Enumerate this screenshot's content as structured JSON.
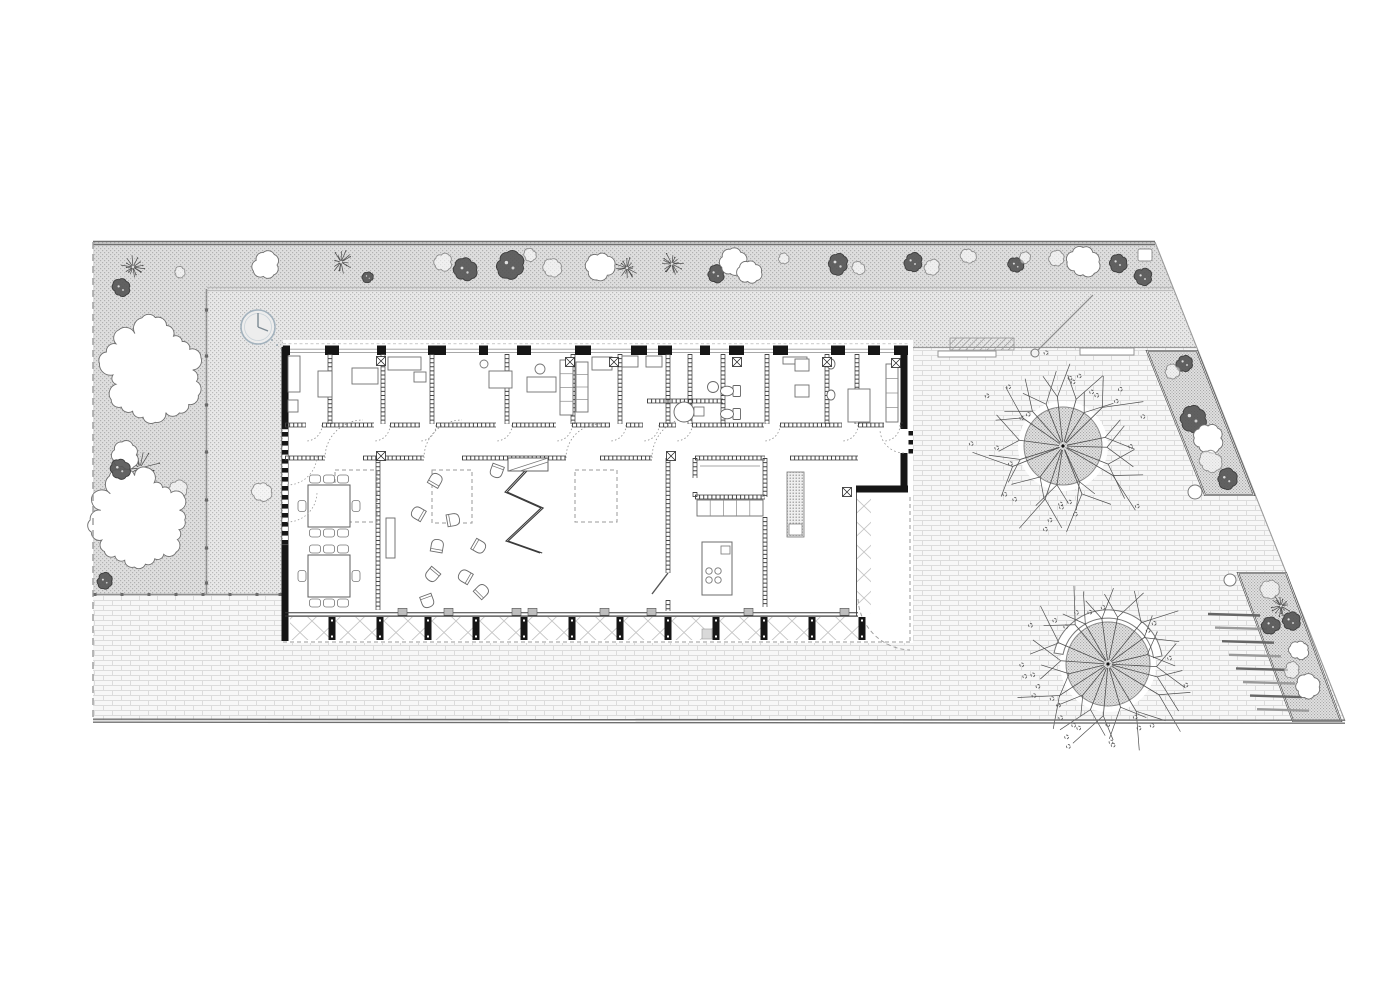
{
  "meta": {
    "width": 1400,
    "height": 990,
    "title": "site-floor-plan"
  },
  "colors": {
    "ink": "#1f1f1f",
    "wall": "#161616",
    "mid": "#555555",
    "soft": "#8a8a8a",
    "light": "#9c9c9c",
    "faint": "#bdbdbd",
    "white": "#ffffff",
    "hatch_bg": "#e8e8e8",
    "hatch_dot": "#b9b9b9",
    "bed_bg": "#e1e1e1",
    "bed_dot": "#a8a8a8",
    "brick_bg": "#f7f7f7",
    "brick_line": "#dcdcdc",
    "deck": "#c6c6c6",
    "clock": "#a3b2bd",
    "boundary": "#6f6f6f"
  },
  "site": {
    "outline": [
      [
        93,
        242
      ],
      [
        1155,
        242
      ],
      [
        1345,
        721
      ],
      [
        93,
        721
      ]
    ],
    "top_line_y": [
      241.5,
      244.5
    ],
    "left_dash_x": 93,
    "bottom_line_y": [
      719.2,
      722.2
    ],
    "slope": [
      1155,
      242,
      1345,
      721
    ]
  },
  "regions": {
    "grass_L": [
      [
        93,
        242
      ],
      [
        1155,
        242
      ],
      [
        1174,
        289
      ],
      [
        207,
        289
      ],
      [
        207,
        595
      ],
      [
        93,
        595
      ]
    ],
    "court": [
      [
        207,
        289
      ],
      [
        1174,
        289
      ],
      [
        1197,
        348
      ],
      [
        285,
        348
      ],
      [
        285,
        595
      ],
      [
        207,
        595
      ]
    ]
  },
  "courtyard": {
    "band_y289": {
      "x1": 207,
      "x2": 1173,
      "ys": [
        287.5,
        290.5
      ]
    },
    "vline207": {
      "x": 206.5,
      "y1": 289,
      "y2": 595,
      "dots_y": [
        310,
        356,
        405,
        452,
        500,
        548,
        583
      ]
    },
    "hline595": {
      "y": 594.5,
      "x1": 93,
      "x2": 284,
      "dots_x": [
        95,
        122,
        149,
        176,
        203,
        230,
        257,
        280
      ]
    },
    "hline348": {
      "y": 347.5,
      "x1": 908,
      "x2": 1196
    },
    "clock": {
      "c": [
        258,
        327
      ],
      "r": 17,
      "hands": [
        [
          258,
          313
        ],
        [
          268,
          331
        ]
      ],
      "trail": [
        [
          272,
          340
        ],
        [
          277,
          345
        ],
        [
          282,
          350
        ]
      ]
    },
    "pole": {
      "line": [
        1035,
        353,
        1093,
        295
      ],
      "circle": [
        1035,
        353,
        4
      ]
    },
    "ramp": [
      950,
      338,
      64,
      12
    ],
    "benches": [
      [
        938,
        351,
        58,
        6
      ],
      [
        1080,
        348,
        54,
        7
      ]
    ],
    "bench_sq": [
      1138,
      249,
      14,
      12
    ]
  },
  "beds": [
    {
      "poly": [
        [
          1147,
          351
        ],
        [
          1197,
          351
        ],
        [
          1254,
          495
        ],
        [
          1205,
          495
        ]
      ]
    },
    {
      "poly": [
        [
          1238,
          573
        ],
        [
          1286,
          573
        ],
        [
          1341,
          721
        ],
        [
          1293,
          721
        ]
      ]
    }
  ],
  "pots": [
    [
      1195,
      492,
      7
    ],
    [
      1230,
      580,
      6
    ]
  ],
  "steps": {
    "x0": 1208,
    "y0": 614,
    "dx": 7,
    "dy": 13.6,
    "len": 52,
    "n": 8
  },
  "trees_large": [
    {
      "c": [
        1063,
        446
      ],
      "canopy": 39,
      "branch": 88,
      "n": 19,
      "seed": 7,
      "leaves": 26
    },
    {
      "c": [
        1108,
        664
      ],
      "canopy": 42,
      "branch": 92,
      "n": 19,
      "seed": 13,
      "leaves": 28,
      "bench": {
        "r1": 46,
        "r2": 55,
        "path": "M1054,653 A55,55 0 0 1 1162,656 L1153.5,657.6 A46,46 0 0 0 1063,654.4 Z"
      }
    }
  ],
  "flora": [
    [
      "spiky",
      133,
      267,
      12
    ],
    [
      "blob",
      121,
      288,
      8
    ],
    [
      "scrib",
      180,
      272,
      5
    ],
    [
      "cloud",
      266,
      265,
      13
    ],
    [
      "spiky",
      341,
      262,
      12
    ],
    [
      "blob",
      368,
      277,
      5
    ],
    [
      "scrib",
      443,
      262,
      8
    ],
    [
      "blob",
      465,
      270,
      10
    ],
    [
      "blob",
      510,
      265,
      12
    ],
    [
      "scrib",
      530,
      255,
      6
    ],
    [
      "scrib",
      553,
      268,
      9
    ],
    [
      "cloud",
      600,
      266,
      13
    ],
    [
      "spiky",
      627,
      268,
      11
    ],
    [
      "spiky",
      672,
      264,
      12
    ],
    [
      "blob",
      716,
      274,
      8
    ],
    [
      "cloud",
      733,
      262,
      12
    ],
    [
      "cloud",
      750,
      272,
      11
    ],
    [
      "scrib",
      784,
      259,
      5
    ],
    [
      "blob",
      838,
      264,
      10
    ],
    [
      "scrib",
      858,
      268,
      6
    ],
    [
      "blob",
      913,
      262,
      8
    ],
    [
      "scrib",
      932,
      267,
      7
    ],
    [
      "scrib",
      968,
      256,
      7
    ],
    [
      "blob",
      1016,
      265,
      7
    ],
    [
      "scrib",
      1025,
      258,
      5
    ],
    [
      "scrib",
      1057,
      259,
      7
    ],
    [
      "cloud",
      1083,
      262,
      14
    ],
    [
      "blob",
      1118,
      263,
      8
    ],
    [
      "blob",
      1143,
      277,
      8
    ],
    [
      "cloud",
      152,
      370,
      46
    ],
    [
      "spiky",
      140,
      468,
      20
    ],
    [
      "scrib",
      177,
      490,
      9
    ],
    [
      "cloud",
      140,
      520,
      47
    ],
    [
      "cloud",
      125,
      455,
      13
    ],
    [
      "blob",
      120,
      469,
      9
    ],
    [
      "scrib",
      262,
      492,
      9
    ],
    [
      "blob",
      105,
      581,
      7
    ],
    [
      "blob",
      1185,
      363,
      8
    ],
    [
      "scrib",
      1172,
      372,
      7
    ],
    [
      "blob",
      1193,
      418,
      12
    ],
    [
      "cloud",
      1208,
      438,
      14
    ],
    [
      "scrib",
      1210,
      462,
      10
    ],
    [
      "blob",
      1227,
      479,
      9
    ],
    [
      "scrib",
      1270,
      589,
      9
    ],
    [
      "spiky",
      1281,
      606,
      11
    ],
    [
      "blob",
      1271,
      625,
      8
    ],
    [
      "blob",
      1291,
      621,
      8
    ],
    [
      "cloud",
      1299,
      650,
      9
    ],
    [
      "scrib",
      1292,
      670,
      7
    ],
    [
      "cloud",
      1307,
      687,
      11
    ]
  ],
  "building": {
    "white": [
      283,
      340,
      630,
      303
    ],
    "top_wall": {
      "y": 345.5,
      "h": 9.5,
      "x1": 283,
      "x2": 908,
      "piers": [
        [
          283,
          7
        ],
        [
          325,
          14
        ],
        [
          377,
          9
        ],
        [
          428,
          18
        ],
        [
          479,
          9
        ],
        [
          517,
          14
        ],
        [
          575,
          16
        ],
        [
          631,
          16
        ],
        [
          658,
          14
        ],
        [
          700,
          10
        ],
        [
          729,
          15
        ],
        [
          773,
          15
        ],
        [
          831,
          14
        ],
        [
          868,
          12
        ],
        [
          894,
          14
        ]
      ],
      "win_lines": [
        349.2,
        352.4
      ],
      "canopy_dash_y": 343.8
    },
    "left_wall": {
      "x": 285,
      "solid": [
        [
          347,
          429
        ],
        [
          545,
          641
        ]
      ],
      "window": [
        429,
        545
      ]
    },
    "right_wall": {
      "x": 904,
      "solid": [
        [
          349,
          429
        ],
        [
          453,
          490
        ]
      ],
      "door_squares": [
        431,
        440,
        449
      ]
    },
    "step_wall": {
      "y": 489,
      "x1": 856,
      "x2": 908
    },
    "corridor_wall": {
      "y": 425,
      "x1": 285,
      "x2": 903,
      "gaps": [
        [
          306,
          322
        ],
        [
          374,
          390
        ],
        [
          420,
          436
        ],
        [
          496,
          512
        ],
        [
          556,
          572
        ],
        [
          610,
          626
        ],
        [
          643,
          659
        ],
        [
          676,
          692
        ],
        [
          764,
          780
        ],
        [
          842,
          858
        ],
        [
          884,
          900
        ]
      ]
    },
    "hall_wall": {
      "y": 458,
      "segs": [
        [
          285,
          325
        ],
        [
          363,
          424
        ],
        [
          462,
          566
        ],
        [
          600,
          652
        ],
        [
          790,
          858
        ]
      ],
      "arc_gaps": [
        [
          325,
          363
        ],
        [
          424,
          462
        ],
        [
          566,
          600
        ],
        [
          652,
          693
        ]
      ]
    },
    "vwalls_main": [
      [
        378,
        458,
        610
      ],
      [
        668,
        458,
        573
      ],
      [
        668,
        600,
        611
      ],
      [
        765,
        517,
        607
      ]
    ],
    "room_vwalls": {
      "y1": 354,
      "y2": 424,
      "xs": [
        330,
        383,
        432,
        507,
        573,
        620,
        668,
        690,
        723,
        767,
        827,
        857
      ]
    },
    "room_hwall": [
      647,
      401,
      723,
      401
    ],
    "bottom_wall": {
      "y1": 612.8,
      "y2": 616,
      "x1": 285,
      "x2": 858,
      "blocks": [
        398,
        444,
        512,
        528,
        600,
        647,
        744,
        840
      ]
    },
    "diag_door": [
      668,
      573,
      652,
      594
    ],
    "entry_arc": "M904,453 A24,24 0 0 1 880,429"
  },
  "veranda": {
    "deck_bottom": [
      290,
      617,
      570,
      23
    ],
    "deck_right": [
      857,
      497,
      14,
      117
    ],
    "columns": {
      "xs": [
        332,
        380,
        428,
        476,
        524,
        572,
        620,
        668,
        716,
        764,
        812,
        862
      ],
      "y": 617,
      "w": 7,
      "h": 23
    },
    "edge_lines": [
      [
        285,
        616.2,
        858,
        616.2
      ],
      [
        856.5,
        490,
        856.5,
        616
      ]
    ],
    "dash_lines": [
      [
        283,
        642,
        910,
        642
      ],
      [
        910,
        497,
        910,
        642
      ]
    ],
    "door_arc": "M858,599 A54,54 0 0 0 910,650",
    "mat": [
      702,
      629,
      10,
      10
    ]
  },
  "hall": {
    "rugs": [
      [
        335,
        470,
        42,
        52
      ],
      [
        432,
        470,
        40,
        53
      ],
      [
        575,
        470,
        42,
        52
      ]
    ],
    "zigzag": [
      [
        536,
        459
      ],
      [
        505,
        492
      ],
      [
        541,
        508
      ],
      [
        506,
        541
      ],
      [
        540,
        553
      ]
    ],
    "zig_top": [
      508,
      458,
      40,
      13
    ],
    "shelf": [
      386,
      518,
      9,
      40
    ],
    "chairs": [
      [
        497,
        470,
        200
      ],
      [
        435,
        481,
        30
      ],
      [
        419,
        514,
        300
      ],
      [
        452,
        520,
        80
      ],
      [
        437,
        547,
        10
      ],
      [
        478,
        546,
        120
      ],
      [
        433,
        574,
        220
      ],
      [
        466,
        577,
        300
      ],
      [
        481,
        592,
        45
      ],
      [
        427,
        600,
        160
      ]
    ],
    "tables": [
      [
        329,
        506
      ],
      [
        329,
        576
      ]
    ],
    "table_size": 42,
    "french_arcs": [
      [
        287,
        455
      ],
      [
        287,
        492
      ]
    ]
  },
  "kitchen": {
    "box": [
      695,
      458,
      70,
      39
    ],
    "door_gap": [
      478,
      492
    ],
    "inner_shelf": [
      700,
      466,
      760,
      466
    ],
    "counter": [
      697,
      500,
      66,
      16
    ],
    "counter_divs": 4,
    "island": [
      702,
      542,
      30,
      53
    ],
    "burners": [
      [
        709,
        571
      ],
      [
        718,
        571
      ],
      [
        709,
        580
      ],
      [
        718,
        580
      ]
    ],
    "sink": [
      721,
      546,
      9,
      8
    ],
    "pantry": [
      787,
      472,
      17,
      65
    ],
    "pantry_sq": [
      789,
      524,
      13,
      11
    ]
  },
  "toprooms": {
    "furn": [
      [
        288,
        356,
        12,
        36
      ],
      [
        288,
        400,
        10,
        12
      ],
      [
        318,
        371,
        14,
        26
      ],
      [
        352,
        368,
        26,
        16
      ],
      [
        388,
        357,
        33,
        13
      ],
      [
        414,
        372,
        12,
        10
      ],
      [
        489,
        371,
        23,
        17
      ],
      [
        527,
        377,
        29,
        15
      ],
      [
        592,
        357,
        20,
        13
      ],
      [
        622,
        356,
        16,
        11
      ],
      [
        646,
        356,
        16,
        11
      ],
      [
        783,
        357,
        24,
        7
      ],
      [
        795,
        359,
        14,
        12
      ],
      [
        795,
        385,
        14,
        12
      ],
      [
        848,
        389,
        22,
        33
      ]
    ],
    "shelves": [
      [
        560,
        360,
        13,
        55
      ],
      [
        576,
        362,
        12,
        50
      ],
      [
        886,
        364,
        12,
        58
      ]
    ],
    "chair_circles": [
      [
        540,
        369,
        5
      ],
      [
        484,
        364,
        4
      ]
    ],
    "toilets": [
      [
        728,
        391
      ],
      [
        728,
        414
      ]
    ],
    "basin": [
      713,
      387,
      5.5
    ],
    "shower": {
      "circle": [
        684,
        412,
        10
      ],
      "handle": [
        694,
        407,
        10,
        9
      ]
    },
    "sinks": [
      [
        831,
        364
      ],
      [
        831,
        395
      ]
    ],
    "xsyms": [
      [
        381,
        361
      ],
      [
        570,
        362
      ],
      [
        614,
        362
      ],
      [
        737,
        362
      ],
      [
        827,
        362
      ],
      [
        896,
        363
      ],
      [
        381,
        456
      ],
      [
        671,
        456
      ],
      [
        847,
        492
      ]
    ]
  }
}
